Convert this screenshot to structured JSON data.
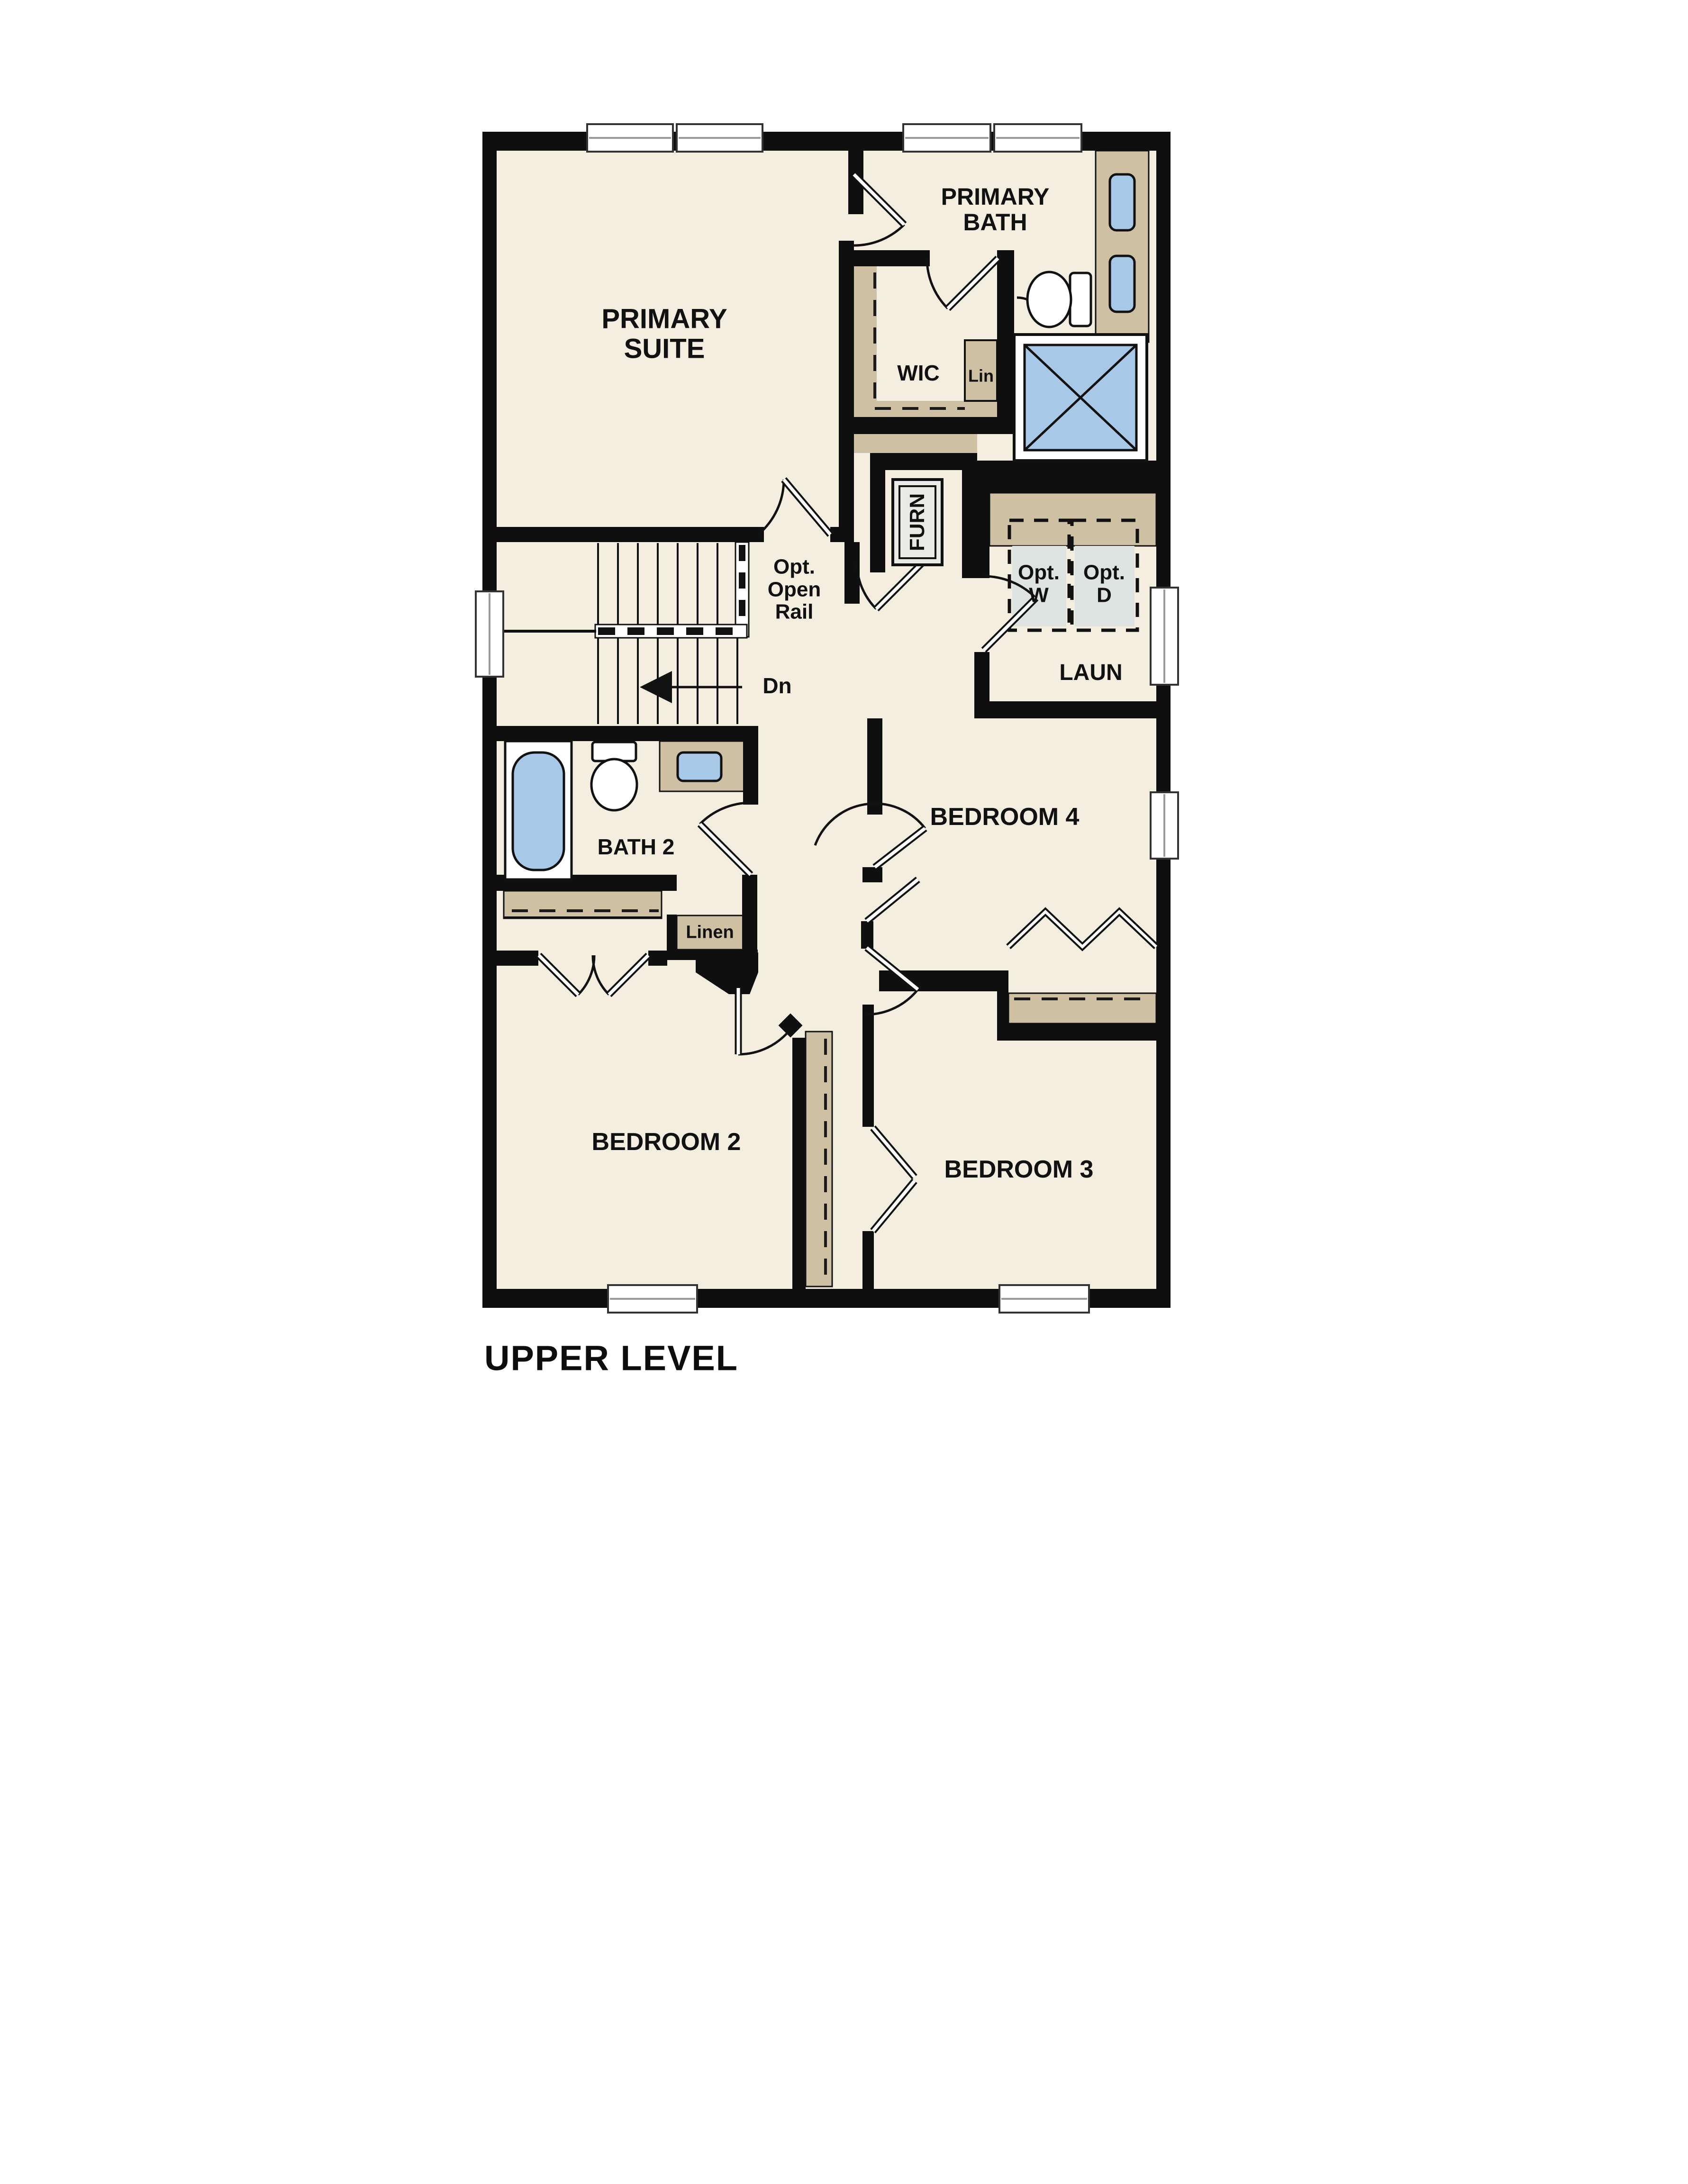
{
  "plan_title": "UPPER LEVEL",
  "rooms": {
    "primary_suite": {
      "line1": "PRIMARY",
      "line2": "SUITE"
    },
    "primary_bath": {
      "line1": "PRIMARY",
      "line2": "BATH"
    },
    "wic": "WIC",
    "lin": "Lin",
    "furnace": "FURN",
    "laundry": "LAUN",
    "bath2": "BATH 2",
    "linen": "Linen",
    "bedroom2": "BEDROOM 2",
    "bedroom3": "BEDROOM 3",
    "bedroom4": "BEDROOM 4"
  },
  "stairs": {
    "open_rail": {
      "line1": "Opt.",
      "line2": "Open",
      "line3": "Rail"
    },
    "down": "Dn"
  },
  "appliances": {
    "washer": {
      "line1": "Opt.",
      "line2": "W"
    },
    "dryer": {
      "line1": "Opt.",
      "line2": "D"
    }
  },
  "colors": {
    "floor_cream": "#f4eee1",
    "casework_tan": "#cdc0a3",
    "fixture_blue": "#a8c8e8",
    "appliance_gray": "#dde3e1",
    "wall_black": "#0f0f0f",
    "background": "#ffffff"
  }
}
